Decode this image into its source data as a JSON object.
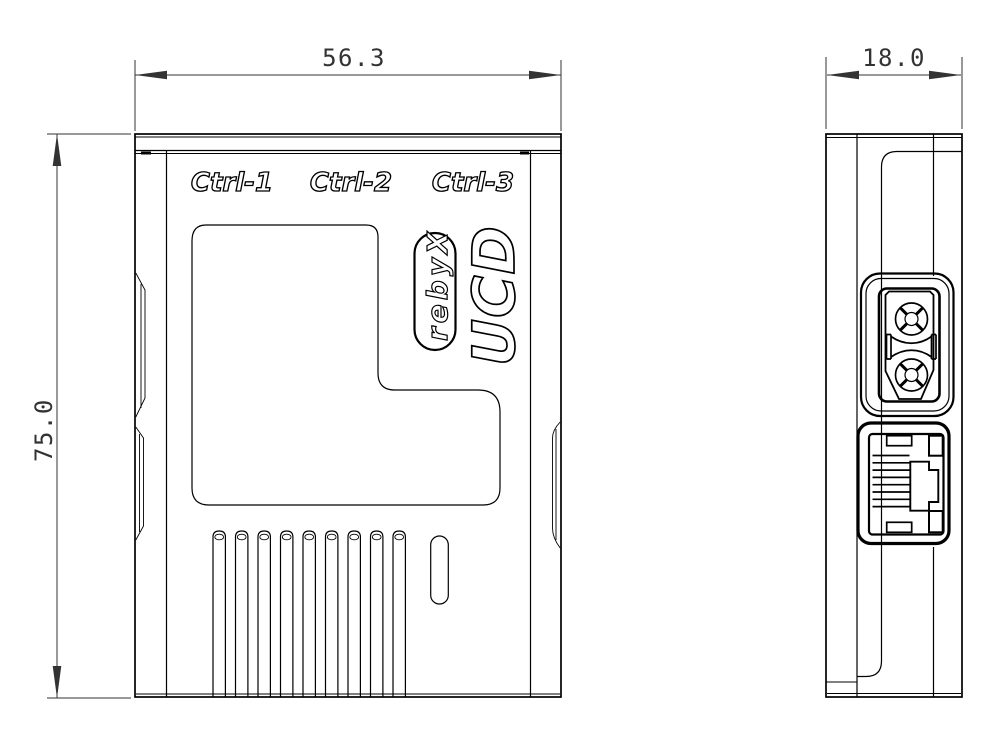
{
  "page": {
    "background": "#ffffff",
    "line_color": "#000000",
    "dimension_color": "#333333"
  },
  "front_view": {
    "port_labels": [
      "Ctrl-1",
      "Ctrl-2",
      "Ctrl-3"
    ],
    "product_name": "DCU",
    "brand_badge": "Xyber",
    "vent_slot_count": 9
  },
  "side_view": {
    "ethernet_contact_count": 8
  },
  "dimensions": {
    "width": "56.3",
    "height": "75.0",
    "depth": "18.0"
  }
}
